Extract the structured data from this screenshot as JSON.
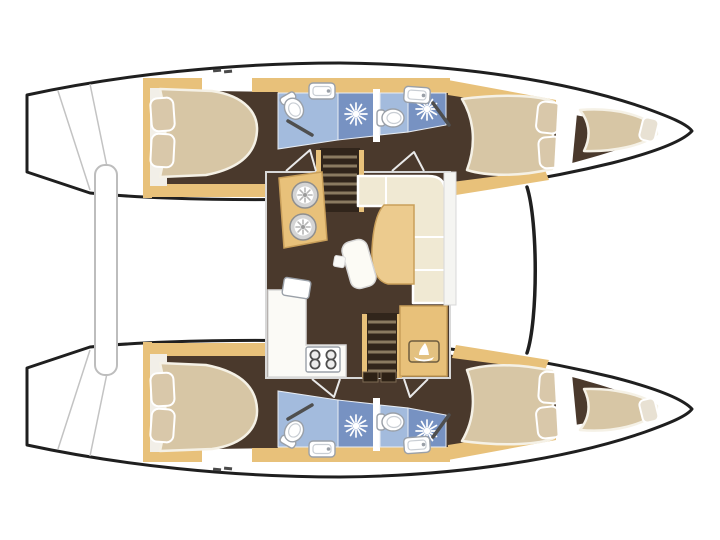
{
  "canvas": {
    "width": 720,
    "height": 540,
    "background": "#ffffff"
  },
  "palette": {
    "outline": "#1f1f1f",
    "deck": "#ffffff",
    "interior": "#4a392c",
    "interior_dark": "#31251b",
    "wood": "#e8c17a",
    "wood_dark": "#c99f5a",
    "mattress": "#d7c6a5",
    "mattress_edge": "#f5f1e6",
    "pillow": "#d9c8aa",
    "pillow_light": "#e8e1d3",
    "bath_floor": "#a3bbdd",
    "shower": "#7792c2",
    "fixture": "#ffffff",
    "fixture_stroke": "#9aa0a8",
    "sofa": "#f0e9d3",
    "table": "#eccb8e",
    "counter": "#fbfaf6",
    "platform": "#f2efe8",
    "stair_tread": "#8a7a60",
    "rod": "#4f4f4f",
    "badge": "#e3c180",
    "badge_edge": "#6d5c3f"
  },
  "plan": {
    "type": "catamaran-interior-floor-plan",
    "hulls": [
      "port",
      "starboard"
    ],
    "rooms_per_hull": [
      "aft-double-cabin",
      "aft-head-with-shower",
      "forward-head-with-shower",
      "forward-double-cabin",
      "bow-berth"
    ],
    "salon_features": [
      "galley-twin-sinks",
      "stairs-to-port-hull",
      "l-shaped-settee",
      "salon-table",
      "swivel-seat",
      "footstool",
      "galley-counter",
      "four-burner-stove",
      "stairs-to-starboard-hull",
      "nav-cabinet-with-boat-badge",
      "companionway-doors"
    ],
    "exterior_features": [
      "transom-steps",
      "cockpit-bench",
      "coachroof-edge",
      "deck-cleats"
    ],
    "fixture_icons": [
      "shower-head-sunburst",
      "toilet",
      "washbasin",
      "sink-drain",
      "stove-burner",
      "boat-badge"
    ]
  }
}
